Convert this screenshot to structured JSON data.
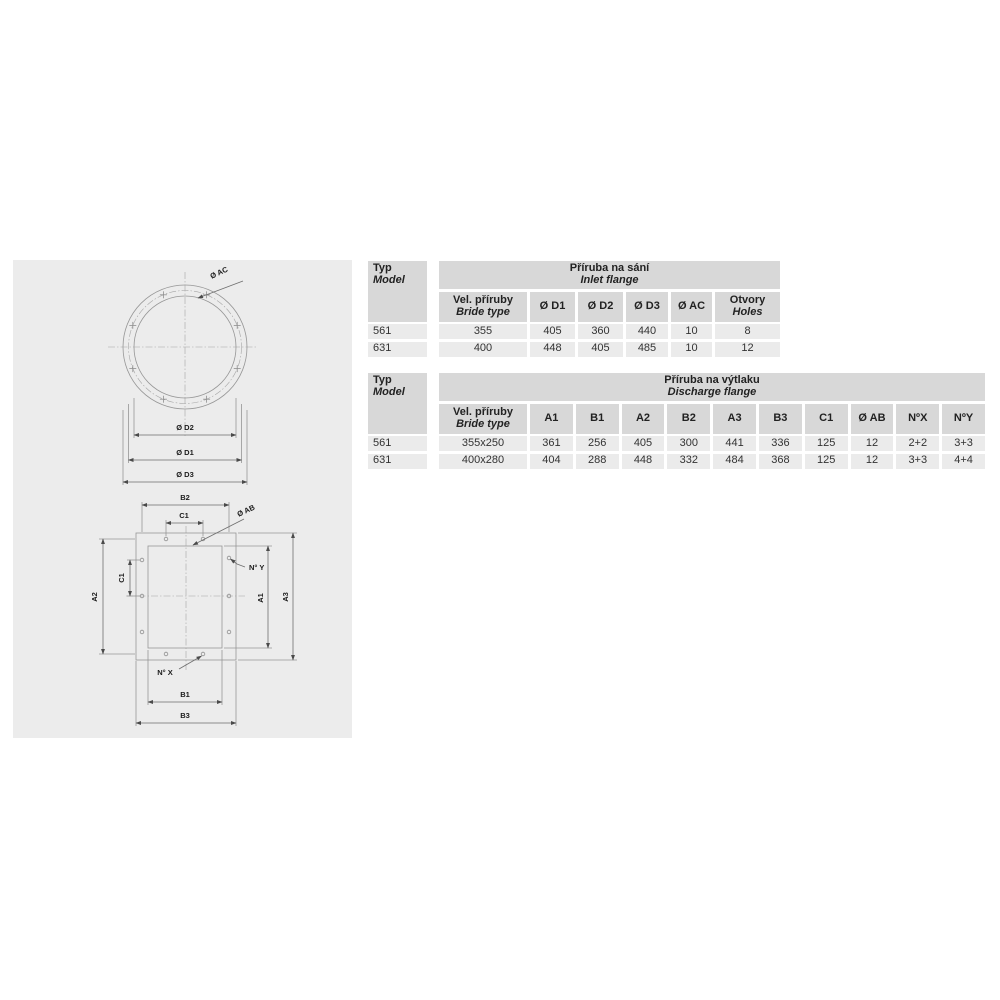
{
  "colors": {
    "panel_bg": "#ececec",
    "header_bg": "#d8d8d8",
    "row_bg": "#ebebeb",
    "drawing_line": "#969696",
    "text": "#333333"
  },
  "drawing": {
    "inlet_labels": {
      "ac": "Ø AC",
      "d2": "Ø D2",
      "d1": "Ø D1",
      "d3": "Ø D3"
    },
    "discharge_labels": {
      "b2": "B2",
      "c1_top": "C1",
      "ab": "Ø AB",
      "ny": "N° Y",
      "c1_left": "C1",
      "a2": "A2",
      "a1": "A1",
      "a3": "A3",
      "nx": "N° X",
      "b1": "B1",
      "b3": "B3"
    }
  },
  "inlet_table": {
    "typ": "Typ",
    "model": "Model",
    "title_cs": "Příruba na sání",
    "title_en": "Inlet flange",
    "size_cs": "Vel. příruby",
    "size_en": "Bride type",
    "cols": [
      "Ø D1",
      "Ø D2",
      "Ø D3",
      "Ø AC"
    ],
    "holes_cs": "Otvory",
    "holes_en": "Holes",
    "rows": [
      {
        "typ": "561",
        "size": "355",
        "v": [
          "405",
          "360",
          "440",
          "10"
        ],
        "holes": "8"
      },
      {
        "typ": "631",
        "size": "400",
        "v": [
          "448",
          "405",
          "485",
          "10"
        ],
        "holes": "12"
      }
    ]
  },
  "discharge_table": {
    "typ": "Typ",
    "model": "Model",
    "title_cs": "Příruba na výtlaku",
    "title_en": "Discharge flange",
    "size_cs": "Vel. příruby",
    "size_en": "Bride type",
    "cols": [
      "A1",
      "B1",
      "A2",
      "B2",
      "A3",
      "B3",
      "C1",
      "Ø AB",
      "NºX",
      "NºY"
    ],
    "rows": [
      {
        "typ": "561",
        "size": "355x250",
        "v": [
          "361",
          "256",
          "405",
          "300",
          "441",
          "336",
          "125",
          "12",
          "2+2",
          "3+3"
        ]
      },
      {
        "typ": "631",
        "size": "400x280",
        "v": [
          "404",
          "288",
          "448",
          "332",
          "484",
          "368",
          "125",
          "12",
          "3+3",
          "4+4"
        ]
      }
    ]
  }
}
